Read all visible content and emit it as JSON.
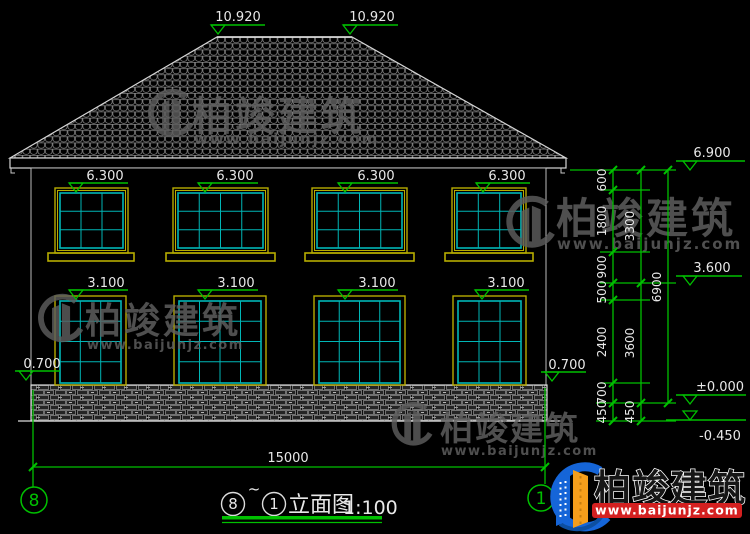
{
  "drawing": {
    "title": {
      "grid_start_bubble": "8",
      "separator": "~",
      "grid_end_bubble": "1",
      "name": "立面图",
      "scale": "1:100"
    },
    "grid_bubbles": {
      "left": "8",
      "right": "1"
    }
  },
  "elevations": {
    "ridge_left": "10.920",
    "ridge_right": "10.920",
    "upper_window_markers": [
      "6.300",
      "6.300",
      "6.300",
      "6.300"
    ],
    "lower_window_markers": [
      "3.100",
      "3.100",
      "3.100",
      "3.100"
    ],
    "plinth_left": "0.700",
    "plinth_right": "0.700",
    "right": {
      "eave": "6.900",
      "second_floor": "3.600",
      "ground": "±0.000",
      "foundation": "-0.450"
    }
  },
  "dimensions": {
    "bottom_total": "15000",
    "right_segments": [
      "600",
      "1800",
      "900",
      "500",
      "2400",
      "700",
      "450"
    ],
    "right_subtotals": [
      "3300",
      "3600",
      "450"
    ],
    "right_total": "6900"
  },
  "watermark": {
    "brand": "柏竣建筑",
    "url": "www.baijunjz.com"
  },
  "corner_logo": {
    "brand": "柏竣建筑",
    "url": "www.baijunjz.com"
  },
  "colors": {
    "annotation_green": "#00c000",
    "window_cyan": "#00b6b6",
    "frame_yellow": "#b6ac00",
    "logo_blue": "#1565d8",
    "logo_orange": "#f59e1b",
    "logo_red": "#d42020"
  }
}
